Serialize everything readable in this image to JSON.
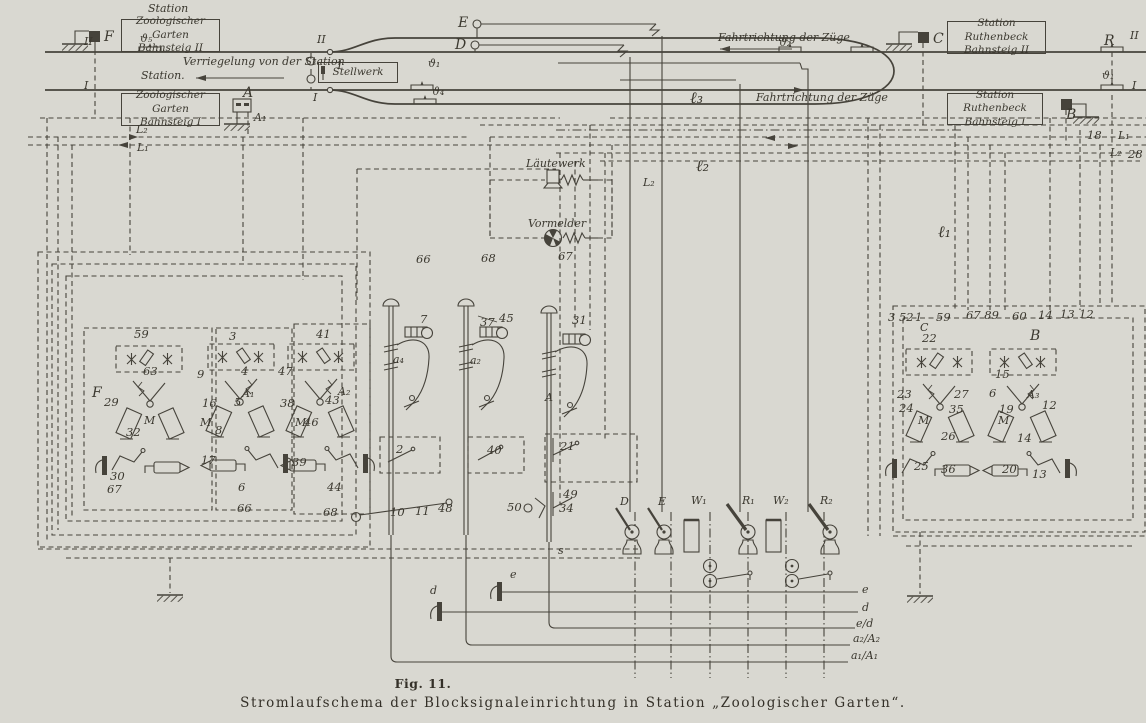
{
  "figure": {
    "fig_label": "Fig. 11.",
    "caption": "Stromlaufschema der Blocksignaleinrichtung in Station „Zoologischer Garten“.",
    "paper_color": "#d9d8d1",
    "ink_color": "#46433b"
  },
  "station_boxes": [
    {
      "name": "box-zoologischer-garten-bahnsteig-2",
      "x": 121,
      "y": 19,
      "w": 97,
      "h": 31,
      "lines": [
        "Zoologischer Garten",
        "Bahnsteig II"
      ]
    },
    {
      "name": "box-zoologischer-garten-bahnsteig-1",
      "x": 121,
      "y": 93,
      "w": 97,
      "h": 31,
      "lines": [
        "Zoologischer Garten",
        "Bahnsteig I"
      ]
    },
    {
      "name": "box-station-ruthenbeck-bahnsteig-2",
      "x": 947,
      "y": 21,
      "w": 97,
      "h": 31,
      "lines": [
        "Station Ruthenbeck",
        "Bahnsteig II"
      ]
    },
    {
      "name": "box-station-ruthenbeck-bahnsteig-1",
      "x": 947,
      "y": 93,
      "w": 94,
      "h": 30,
      "lines": [
        "Station Ruthenbeck",
        "Bahnsteig I"
      ]
    },
    {
      "name": "box-stellwerk",
      "x": 318,
      "y": 62,
      "w": 78,
      "h": 19,
      "lines": [
        "Stellwerk"
      ]
    }
  ],
  "labels": [
    {
      "t": "Station",
      "x": 148,
      "y": 3,
      "c": "s",
      "n": "station-heading"
    },
    {
      "t": "II",
      "x": 84,
      "y": 36,
      "c": "s",
      "n": "track-2-label-left"
    },
    {
      "t": "ϑ₅",
      "x": 140,
      "y": 33,
      "c": "s",
      "n": "rail-contact-d5-label"
    },
    {
      "t": "F",
      "x": 104,
      "y": 30,
      "c": "s b",
      "n": "signal-f-label"
    },
    {
      "t": "Verriegelung von der Station",
      "x": 183,
      "y": 56,
      "c": "s",
      "n": "interlocking-note"
    },
    {
      "t": "Station.",
      "x": 141,
      "y": 70,
      "c": "s",
      "n": "station-arrow-label"
    },
    {
      "t": "I",
      "x": 84,
      "y": 80,
      "c": "s",
      "n": "track-1-label-left"
    },
    {
      "t": "1",
      "x": 336,
      "y": 60,
      "c": "n",
      "n": "switch-1-label"
    },
    {
      "t": "II",
      "x": 317,
      "y": 34,
      "c": "s"
    },
    {
      "t": "I",
      "x": 313,
      "y": 92,
      "c": "s"
    },
    {
      "t": "E",
      "x": 458,
      "y": 16,
      "c": "s b",
      "n": "wire-e-label"
    },
    {
      "t": "D",
      "x": 455,
      "y": 38,
      "c": "s b",
      "n": "wire-d-label"
    },
    {
      "t": "ϑ₁",
      "x": 428,
      "y": 58,
      "c": "s",
      "n": "rail-contact-d1-label"
    },
    {
      "t": "ϑ₄",
      "x": 432,
      "y": 86,
      "c": "s",
      "n": "rail-contact-d4-label"
    },
    {
      "t": "Fahrtrichtung der Züge",
      "x": 718,
      "y": 32,
      "c": "s",
      "n": "direction-label-track2"
    },
    {
      "t": "ϑ₂",
      "x": 779,
      "y": 37,
      "c": "s",
      "n": "rail-contact-d2-label"
    },
    {
      "t": "C",
      "x": 933,
      "y": 32,
      "c": "s b",
      "n": "signal-c-label"
    },
    {
      "t": "R",
      "x": 1104,
      "y": 34,
      "c": "s b",
      "n": "rail-contact-r-label"
    },
    {
      "t": "II",
      "x": 1130,
      "y": 30,
      "c": "s",
      "n": "track-2-label-right"
    },
    {
      "t": "ϑ₁",
      "x": 1102,
      "y": 70,
      "c": "s"
    },
    {
      "t": "I",
      "x": 1132,
      "y": 80,
      "c": "s",
      "n": "track-1-label-right"
    },
    {
      "t": "Fahrtrichtung der Züge",
      "x": 756,
      "y": 92,
      "c": "s",
      "n": "direction-label-track1"
    },
    {
      "t": "A",
      "x": 243,
      "y": 86,
      "c": "s b",
      "n": "signal-a-label"
    },
    {
      "t": "A₁",
      "x": 254,
      "y": 112,
      "c": "s",
      "n": "signal-a1-label"
    },
    {
      "t": "B",
      "x": 1066,
      "y": 108,
      "c": "s b",
      "n": "signal-b-label"
    },
    {
      "t": "L₂",
      "x": 136,
      "y": 124,
      "c": "s",
      "n": "bus-l2-label-left"
    },
    {
      "t": "L₁",
      "x": 137,
      "y": 142,
      "c": "s",
      "n": "bus-l1-label-left"
    },
    {
      "t": "18",
      "x": 1087,
      "y": 130,
      "c": "n"
    },
    {
      "t": "L₁",
      "x": 1118,
      "y": 130,
      "c": "s",
      "n": "bus-l1-label-right"
    },
    {
      "t": "L₂",
      "x": 1110,
      "y": 147,
      "c": "s",
      "n": "bus-l2-label-right"
    },
    {
      "t": "28",
      "x": 1128,
      "y": 149,
      "c": "n"
    },
    {
      "t": "ℓ₃",
      "x": 690,
      "y": 90,
      "c": "s b2",
      "n": "line-wire-l3-label"
    },
    {
      "t": "ℓ₂",
      "x": 696,
      "y": 158,
      "c": "s b2",
      "n": "line-wire-l2-label"
    },
    {
      "t": "L₂",
      "x": 643,
      "y": 177,
      "c": "s"
    },
    {
      "t": "ℓ₁",
      "x": 938,
      "y": 224,
      "c": "s b2",
      "n": "line-wire-l1-label"
    },
    {
      "t": "Läutewerk",
      "x": 526,
      "y": 158,
      "c": "s",
      "n": "bell-label"
    },
    {
      "t": "Vormelder",
      "x": 528,
      "y": 218,
      "c": "s",
      "n": "annunciator-label"
    },
    {
      "t": "66",
      "x": 416,
      "y": 254,
      "c": "n"
    },
    {
      "t": "68",
      "x": 481,
      "y": 253,
      "c": "n"
    },
    {
      "t": "67",
      "x": 558,
      "y": 251,
      "c": "n"
    },
    {
      "t": "7",
      "x": 420,
      "y": 314,
      "c": "n"
    },
    {
      "t": "37",
      "x": 480,
      "y": 317,
      "c": "n"
    },
    {
      "t": "45",
      "x": 499,
      "y": 313,
      "c": "n"
    },
    {
      "t": "31",
      "x": 572,
      "y": 315,
      "c": "n"
    },
    {
      "t": "a₄",
      "x": 393,
      "y": 354,
      "c": "s",
      "n": "lever-a4-label"
    },
    {
      "t": "a₂",
      "x": 470,
      "y": 355,
      "c": "s",
      "n": "lever-a2-label"
    },
    {
      "t": "A",
      "x": 545,
      "y": 392,
      "c": "s",
      "n": "lever-a-label"
    },
    {
      "t": "2",
      "x": 396,
      "y": 444,
      "c": "n"
    },
    {
      "t": "40",
      "x": 487,
      "y": 445,
      "c": "n"
    },
    {
      "t": "21",
      "x": 560,
      "y": 441,
      "c": "n"
    },
    {
      "t": "49",
      "x": 563,
      "y": 489,
      "c": "n"
    },
    {
      "t": "34",
      "x": 559,
      "y": 503,
      "c": "n"
    },
    {
      "t": "50",
      "x": 507,
      "y": 502,
      "c": "n"
    },
    {
      "t": "10",
      "x": 390,
      "y": 507,
      "c": "n"
    },
    {
      "t": "11",
      "x": 415,
      "y": 506,
      "c": "n"
    },
    {
      "t": "48",
      "x": 438,
      "y": 503,
      "c": "n"
    },
    {
      "t": "s",
      "x": 558,
      "y": 545,
      "c": "s"
    },
    {
      "t": "59",
      "x": 134,
      "y": 329,
      "c": "n"
    },
    {
      "t": "63",
      "x": 143,
      "y": 366,
      "c": "n"
    },
    {
      "t": "3",
      "x": 229,
      "y": 331,
      "c": "n"
    },
    {
      "t": "41",
      "x": 316,
      "y": 329,
      "c": "n"
    },
    {
      "t": "9",
      "x": 197,
      "y": 369,
      "c": "n"
    },
    {
      "t": "4",
      "x": 241,
      "y": 366,
      "c": "n"
    },
    {
      "t": "47",
      "x": 278,
      "y": 366,
      "c": "n"
    },
    {
      "t": "F",
      "x": 92,
      "y": 386,
      "c": "s b",
      "n": "relay-f-label"
    },
    {
      "t": "29",
      "x": 104,
      "y": 397,
      "c": "n"
    },
    {
      "t": "16",
      "x": 202,
      "y": 398,
      "c": "n"
    },
    {
      "t": "5",
      "x": 234,
      "y": 397,
      "c": "n"
    },
    {
      "t": "A₁",
      "x": 242,
      "y": 388,
      "c": "s",
      "n": "relay-a1-label"
    },
    {
      "t": "38",
      "x": 280,
      "y": 398,
      "c": "n"
    },
    {
      "t": "43",
      "x": 325,
      "y": 395,
      "c": "n"
    },
    {
      "t": "A₂",
      "x": 338,
      "y": 386,
      "c": "s",
      "n": "relay-a2-label"
    },
    {
      "t": "32",
      "x": 126,
      "y": 427,
      "c": "n"
    },
    {
      "t": "8",
      "x": 215,
      "y": 425,
      "c": "n"
    },
    {
      "t": "46",
      "x": 304,
      "y": 417,
      "c": "n"
    },
    {
      "t": "M",
      "x": 144,
      "y": 415,
      "c": "s"
    },
    {
      "t": "M",
      "x": 200,
      "y": 417,
      "c": "s"
    },
    {
      "t": "M",
      "x": 295,
      "y": 417,
      "c": "s"
    },
    {
      "t": "30",
      "x": 110,
      "y": 471,
      "c": "n"
    },
    {
      "t": "67",
      "x": 107,
      "y": 484,
      "c": "n"
    },
    {
      "t": "17",
      "x": 201,
      "y": 455,
      "c": "n"
    },
    {
      "t": "39",
      "x": 292,
      "y": 457,
      "c": "n"
    },
    {
      "t": "6",
      "x": 238,
      "y": 482,
      "c": "n"
    },
    {
      "t": "44",
      "x": 327,
      "y": 482,
      "c": "n"
    },
    {
      "t": "66",
      "x": 237,
      "y": 503,
      "c": "n"
    },
    {
      "t": "68",
      "x": 323,
      "y": 507,
      "c": "n"
    },
    {
      "t": "3 52",
      "x": 888,
      "y": 312,
      "c": "n"
    },
    {
      "t": "1",
      "x": 915,
      "y": 312,
      "c": "n"
    },
    {
      "t": "C",
      "x": 920,
      "y": 322,
      "c": "s",
      "n": "relay-c-label"
    },
    {
      "t": "59",
      "x": 936,
      "y": 312,
      "c": "n"
    },
    {
      "t": "67 89",
      "x": 966,
      "y": 310,
      "c": "n"
    },
    {
      "t": "60",
      "x": 1012,
      "y": 311,
      "c": "n"
    },
    {
      "t": "14",
      "x": 1038,
      "y": 310,
      "c": "n"
    },
    {
      "t": "13",
      "x": 1060,
      "y": 309,
      "c": "n"
    },
    {
      "t": "12",
      "x": 1079,
      "y": 309,
      "c": "n"
    },
    {
      "t": "22",
      "x": 922,
      "y": 333,
      "c": "n"
    },
    {
      "t": "B",
      "x": 1030,
      "y": 329,
      "c": "s b",
      "n": "relay-b-label"
    },
    {
      "t": "15",
      "x": 995,
      "y": 369,
      "c": "n"
    },
    {
      "t": "23",
      "x": 897,
      "y": 389,
      "c": "n"
    },
    {
      "t": "27",
      "x": 954,
      "y": 389,
      "c": "n"
    },
    {
      "t": "6",
      "x": 989,
      "y": 388,
      "c": "n"
    },
    {
      "t": "A₃",
      "x": 1027,
      "y": 389,
      "c": "s",
      "n": "relay-a3-label"
    },
    {
      "t": "24",
      "x": 899,
      "y": 403,
      "c": "n"
    },
    {
      "t": "35",
      "x": 949,
      "y": 404,
      "c": "n"
    },
    {
      "t": "19",
      "x": 999,
      "y": 404,
      "c": "n"
    },
    {
      "t": "12",
      "x": 1042,
      "y": 400,
      "c": "n"
    },
    {
      "t": "26",
      "x": 941,
      "y": 431,
      "c": "n"
    },
    {
      "t": "14",
      "x": 1017,
      "y": 433,
      "c": "n"
    },
    {
      "t": "25",
      "x": 914,
      "y": 461,
      "c": "n"
    },
    {
      "t": "36",
      "x": 941,
      "y": 464,
      "c": "n"
    },
    {
      "t": "20",
      "x": 1002,
      "y": 464,
      "c": "n"
    },
    {
      "t": "13",
      "x": 1032,
      "y": 469,
      "c": "n"
    },
    {
      "t": "M",
      "x": 918,
      "y": 415,
      "c": "s"
    },
    {
      "t": "M",
      "x": 998,
      "y": 415,
      "c": "s"
    },
    {
      "t": "e",
      "x": 510,
      "y": 569,
      "c": "s",
      "n": "battery-e-label"
    },
    {
      "t": "d",
      "x": 430,
      "y": 585,
      "c": "s",
      "n": "battery-d-label"
    },
    {
      "t": "e",
      "x": 862,
      "y": 584,
      "c": "s",
      "n": "bus-e-label"
    },
    {
      "t": "d",
      "x": 862,
      "y": 602,
      "c": "s",
      "n": "bus-d-label"
    },
    {
      "t": "e/d",
      "x": 856,
      "y": 618,
      "c": "s",
      "n": "bus-ed-label"
    },
    {
      "t": "a₂/A₂",
      "x": 853,
      "y": 633,
      "c": "s",
      "n": "bus-a2-label"
    },
    {
      "t": "a₁/A₁",
      "x": 851,
      "y": 650,
      "c": "s",
      "n": "bus-a1-label"
    },
    {
      "t": "D",
      "x": 620,
      "y": 496,
      "c": "s",
      "n": "block-instrument-d-label"
    },
    {
      "t": "E",
      "x": 658,
      "y": 496,
      "c": "s",
      "n": "block-instrument-e-label"
    },
    {
      "t": "W₁",
      "x": 691,
      "y": 495,
      "c": "s",
      "n": "block-instrument-w1-label"
    },
    {
      "t": "R₁",
      "x": 742,
      "y": 495,
      "c": "s",
      "n": "block-instrument-r1-label"
    },
    {
      "t": "W₂",
      "x": 773,
      "y": 495,
      "c": "s",
      "n": "block-instrument-w2-label"
    },
    {
      "t": "R₂",
      "x": 820,
      "y": 495,
      "c": "s",
      "n": "block-instrument-r2-label"
    }
  ]
}
